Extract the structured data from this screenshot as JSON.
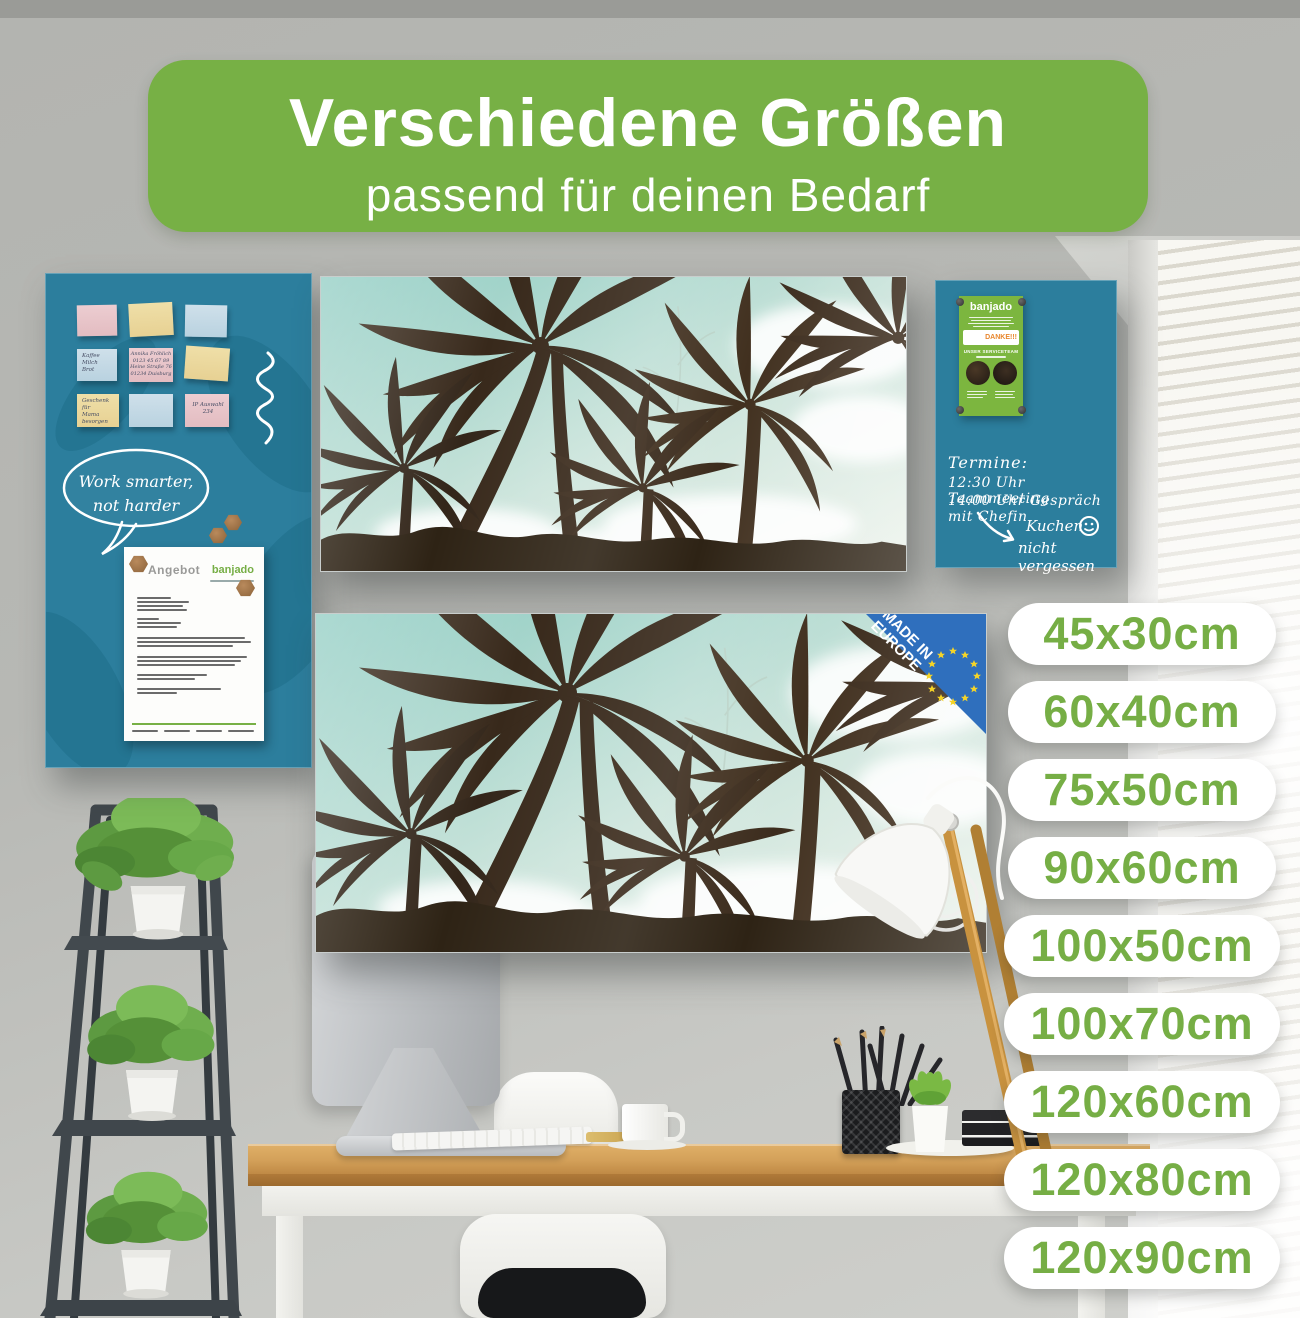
{
  "banner": {
    "title": "Verschiedene Größen",
    "subtitle": "passend für deinen Bedarf"
  },
  "sizes": [
    "45x30cm",
    "60x40cm",
    "75x50cm",
    "90x60cm",
    "100x50cm",
    "100x70cm",
    "120x60cm",
    "120x80cm",
    "120x90cm"
  ],
  "colors": {
    "accent_green": "#77b045",
    "pill_text_green": "#76ae45",
    "board_teal": "#2c7e9d",
    "flyer_green": "#7cb63f",
    "badge_blue": "#2f6fbd",
    "badge_star_yellow": "#f5d428",
    "desk_wood": "#d3a059"
  },
  "left_board": {
    "sticky_notes": [
      {
        "color": "pink",
        "text": ""
      },
      {
        "color": "yellow",
        "text": ""
      },
      {
        "color": "blue",
        "text": ""
      },
      {
        "color": "blue",
        "text": "Kaffee\nMilch\nBrot"
      },
      {
        "color": "pink",
        "text": "Annika Fröhlich\n0123 45 67 89\nHeine Straße 76\n01234 Duisburg"
      },
      {
        "color": "yellow",
        "text": ""
      },
      {
        "color": "yellow",
        "text": "Geschenk für\nMama\nbesorgen"
      },
      {
        "color": "blue",
        "text": ""
      },
      {
        "color": "pink",
        "text": "IP Auswahl\n234"
      }
    ],
    "speech_bubble": "Work smarter,\nnot harder",
    "document": {
      "title": "Angebot",
      "brand": "banjado"
    }
  },
  "right_board": {
    "flyer": {
      "brand": "banjado",
      "thanks": "DANKE!!!",
      "team": "UNSER SERVICETEAM"
    },
    "appointments": [
      "Termine:",
      "12:30 Uhr Teammeeting",
      "14:00 Uhr Gespräch mit Chefin"
    ],
    "reminder": [
      "Kuchen",
      "nicht vergessen"
    ]
  },
  "badge": {
    "line1": "MADE IN",
    "line2": "EUROPE"
  }
}
